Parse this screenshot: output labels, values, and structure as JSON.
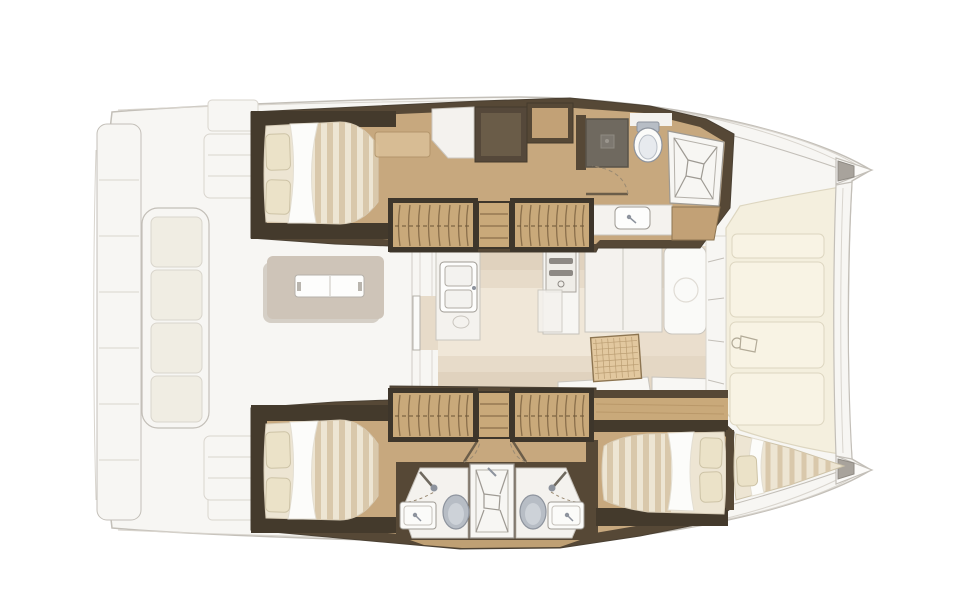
{
  "meta": {
    "content_type": "yacht floor plan illustration",
    "description": "Top-down interior layout plan of a sailing catamaran, bow pointing right, stern at left",
    "visible_text": []
  },
  "colors": {
    "paper": "#ffffff",
    "hull_white": "#f7f6f3",
    "deck_line": "#c3bfb8",
    "deck_line_soft": "#d9d5ce",
    "cream_panel": "#f4efde",
    "cream_panel_bright": "#f8f3e4",
    "cream_line": "#ddd6c0",
    "taupe_platform": "#cec4b8",
    "taupe_shadow": "#b9aea1",
    "cushion": "#f0ede3",
    "interior_wood": "#c7a87e",
    "wood_accent": "#bfa074",
    "wood_light": "#d9bf97",
    "wall_brown": "#564836",
    "wall_dark": "#443a2c",
    "cabinet_dark": "#55483a",
    "cabinet_inner": "#6a5c48",
    "cabinet_wood": "#c2a176",
    "salon_floor": "#e7dbc9",
    "salon_bright": "#f1e9da",
    "salon_shadow": "#d7c7b1",
    "mattress": "#ede5d3",
    "mattress_stripe": "#d9c8ab",
    "sheet": "#fcfcfa",
    "pillow": "#ebe2c8",
    "pillow_line": "#cdc3a6",
    "stair_wood": "#c9a97a",
    "stair_grain": "#8a6f4b",
    "stair_frame": "#3e362b",
    "white_fixture": "#fbfbf9",
    "white_soft": "#f4f2ee",
    "fixture_line": "#9e9a93",
    "toilet_grey": "#b7bdc5",
    "toilet_line": "#8d939d",
    "shower_dark": "#6f695f",
    "shower_dark_line": "#585349",
    "grey_fitting": "#a8a39c",
    "furn_line": "#c9c5be",
    "rattan": "#e2c89f",
    "rattan_line": "#bb9e73",
    "arc_dash": "#9a8a72",
    "door_leaf": "#6b5d49"
  },
  "areas": {
    "cockpit": {
      "label": "Aft cockpit with transom steps, stern bench and folding table",
      "features": [
        "transom platform steps",
        "stern bench with cushions",
        "folding cockpit table",
        "side consoles"
      ]
    },
    "salon": {
      "label": "Salon and galley",
      "features": [
        "galley counter with double sink",
        "stove unit",
        "settee panels",
        "rattan coffee table",
        "forward seat",
        "front windows",
        "aft sliding door"
      ]
    },
    "port_hull": {
      "label": "Port hull: aft double cabin, companionway stairs, wardrobes, forward bathroom",
      "features": [
        "aft double berth with two pillows",
        "wardrobe cabinets",
        "companionway stairs",
        "shower stall",
        "toilet",
        "shower tray",
        "washbasin"
      ]
    },
    "starboard_hull": {
      "label": "Starboard hull: aft double cabin, stairs, twin bathrooms with central shower, forward double cabin, forepeak berth",
      "features": [
        "aft double berth with two pillows",
        "companionway stairs",
        "two toilets",
        "two washbasins",
        "central shower tray",
        "forward double berth",
        "bow forepeak berth"
      ]
    },
    "foredeck": {
      "label": "Foredeck sunpads, crossbeam and twin bows",
      "features": [
        "sunpad panels",
        "winch fitting",
        "forward crossbeam",
        "anchor fittings at bow tips"
      ]
    }
  }
}
